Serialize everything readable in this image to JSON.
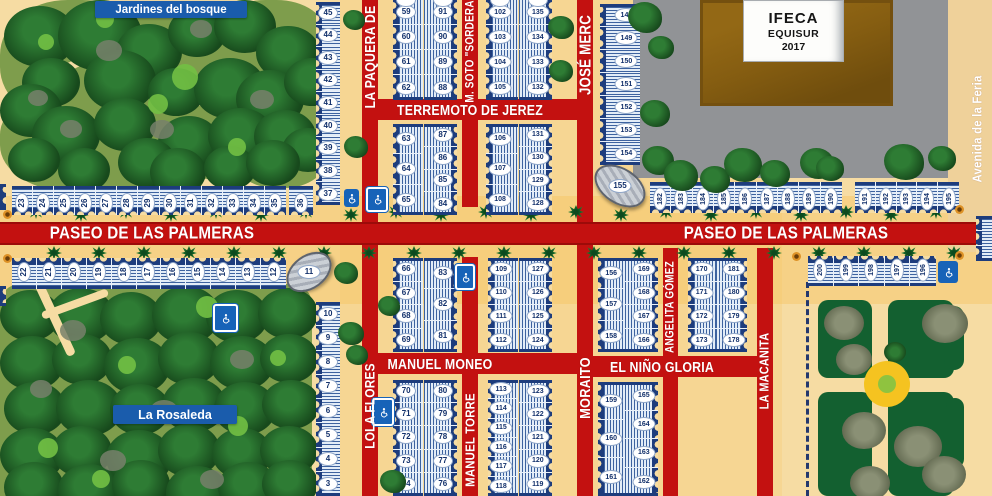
{
  "labels": {
    "jardines": "Jardines del bosque",
    "rosaleda": "La Rosaleda",
    "paseo": "PASEO DE LAS PALMERAS",
    "avenida": "Avenida de la Feria",
    "ifeca_line1": "IFECA",
    "ifeca_line2": "EQUISUR",
    "ifeca_line3": "2017"
  },
  "colors": {
    "ground": "#F6DCA3",
    "navy": "#1D3C7C",
    "road": "#C31110",
    "road_edge": "#9C0B09",
    "caseta_light": "#BFD2E8",
    "stripe_blue": "#264E92",
    "ellipse_text": "#12306B",
    "label_blue": "#1A5CAC",
    "park_olive": "#7E9D4C",
    "tree_dark": "#17491C",
    "tree_mid": "#2E7C34",
    "tree_light": "#72C044",
    "paving_gray": "#919396",
    "building_brown": "#855D11",
    "building_brown_dark": "#6F4D0D",
    "park_deep_green": "#136030",
    "blob_gray": "#7B8465",
    "roundabout_yellow": "#F5C320",
    "roundabout_green": "#8FC33F",
    "icon_blue": "#1763B8",
    "lamp_orange": "#DD9126",
    "dash_navy": "#24386E",
    "avenida_strip": "#EFD19A"
  },
  "streets": [
    {
      "id": "paseo",
      "label": "",
      "x": 0,
      "y": 222,
      "w": 992,
      "h": 23,
      "v": false,
      "fs": 0,
      "lx": 0,
      "ly": 0
    },
    {
      "id": "terremoto-de-jerez",
      "label": "TERREMOTO DE JEREZ",
      "x": 378,
      "y": 99,
      "w": 199,
      "h": 21,
      "v": false,
      "fs": 13,
      "lx": 470,
      "ly": 110
    },
    {
      "id": "manuel-moneo",
      "label": "MANUEL MONEO",
      "x": 378,
      "y": 353,
      "w": 199,
      "h": 21,
      "v": false,
      "fs": 13,
      "lx": 440,
      "ly": 364
    },
    {
      "id": "el-nino-gloria",
      "label": "EL NIÑO GLORIA",
      "x": 593,
      "y": 356,
      "w": 164,
      "h": 21,
      "v": false,
      "fs": 13,
      "lx": 662,
      "ly": 367
    },
    {
      "id": "la-paquera-de",
      "label": "LA PAQUERA DE",
      "x": 362,
      "y": 0,
      "w": 16,
      "h": 222,
      "v": true,
      "fs": 13,
      "lx": 370,
      "ly": 57
    },
    {
      "id": "m-soto-sordera",
      "label": "M. SOTO \"SORDERA\"",
      "x": 462,
      "y": 0,
      "w": 16,
      "h": 207,
      "v": true,
      "fs": 10.5,
      "lx": 470,
      "ly": 49
    },
    {
      "id": "jose-merce",
      "label": "JOSÉ MERC",
      "x": 577,
      "y": 0,
      "w": 16,
      "h": 222,
      "v": true,
      "fs": 14,
      "lx": 585,
      "ly": 55
    },
    {
      "id": "lola-flores",
      "label": "LOLA FLORES",
      "x": 362,
      "y": 245,
      "w": 16,
      "h": 251,
      "v": true,
      "fs": 12.5,
      "lx": 370,
      "ly": 406
    },
    {
      "id": "manuel-torre",
      "label": "MANUEL TORRE",
      "x": 462,
      "y": 257,
      "w": 16,
      "h": 239,
      "v": true,
      "fs": 12,
      "lx": 470,
      "ly": 440
    },
    {
      "id": "moraito",
      "label": "MORAITO",
      "x": 577,
      "y": 245,
      "w": 16,
      "h": 251,
      "v": true,
      "fs": 13.5,
      "lx": 585,
      "ly": 388
    },
    {
      "id": "angelita-gomez",
      "label": "ANGELITA GÓMEZ",
      "x": 663,
      "y": 248,
      "w": 15,
      "h": 248,
      "v": true,
      "fs": 10.5,
      "lx": 670,
      "ly": 307
    },
    {
      "id": "la-macanita",
      "label": "LA MACANITA",
      "x": 757,
      "y": 248,
      "w": 16,
      "h": 248,
      "v": true,
      "fs": 11.5,
      "lx": 765,
      "ly": 371
    }
  ],
  "caseta_groups": [
    {
      "id": "row-23-35",
      "x": 12,
      "y": 186,
      "w": 274,
      "h": 29,
      "dir": "row",
      "stripe": "h",
      "edge": "bottom",
      "rotated": true,
      "numY": 58,
      "numbers": [
        "23",
        "24",
        "25",
        "26",
        "27",
        "28",
        "29",
        "30",
        "31",
        "32",
        "33",
        "34",
        "35"
      ]
    },
    {
      "id": "caseta-36",
      "x": 289,
      "y": 186,
      "w": 24,
      "h": 29,
      "dir": "row",
      "stripe": "h",
      "edge": "bottom",
      "rotated": true,
      "numY": 58,
      "numbers": [
        "36"
      ]
    },
    {
      "id": "col-45-37",
      "x": 316,
      "y": 2,
      "w": 24,
      "h": 203,
      "dir": "col",
      "stripe": "h",
      "edge": "left",
      "numbers": [
        "45",
        "44",
        "43",
        "42",
        "41",
        "40",
        "39",
        "38",
        "37"
      ]
    },
    {
      "id": "col-59-62",
      "x": 393,
      "y": 0,
      "w": 30,
      "h": 100,
      "dir": "col",
      "stripe": "v",
      "edge": "left",
      "numX": 44,
      "phantom": true,
      "numbers": [
        "59",
        "60",
        "61",
        "62"
      ]
    },
    {
      "id": "col-91-88",
      "x": 424,
      "y": 0,
      "w": 33,
      "h": 100,
      "dir": "col",
      "stripe": "v",
      "edge": "right",
      "numX": 57,
      "phantom": true,
      "numbers": [
        "91",
        "90",
        "89",
        "88"
      ]
    },
    {
      "id": "col-102-105",
      "x": 486,
      "y": 0,
      "w": 32,
      "h": 100,
      "dir": "col",
      "stripe": "v",
      "edge": "left",
      "numX": 44,
      "phantom": true,
      "numbers": [
        "102",
        "103",
        "104",
        "105"
      ]
    },
    {
      "id": "col-135-132",
      "x": 519,
      "y": 0,
      "w": 33,
      "h": 100,
      "dir": "col",
      "stripe": "v",
      "edge": "right",
      "numX": 57,
      "phantom": true,
      "numbers": [
        "135",
        "134",
        "133",
        "132"
      ]
    },
    {
      "id": "col-63-65",
      "x": 393,
      "y": 124,
      "w": 30,
      "h": 91,
      "dir": "col",
      "stripe": "v",
      "edge": "left",
      "numX": 44,
      "numbers": [
        "63",
        "64",
        "65"
      ]
    },
    {
      "id": "col-87-84",
      "x": 424,
      "y": 124,
      "w": 33,
      "h": 91,
      "dir": "col",
      "stripe": "v",
      "edge": "right",
      "numX": 57,
      "numbers": [
        "87",
        "86",
        "85",
        "84"
      ]
    },
    {
      "id": "col-106-108",
      "x": 486,
      "y": 124,
      "w": 32,
      "h": 91,
      "dir": "col",
      "stripe": "v",
      "edge": "left",
      "numX": 44,
      "numbers": [
        "106",
        "107",
        "108"
      ]
    },
    {
      "id": "col-131-128",
      "x": 519,
      "y": 124,
      "w": 33,
      "h": 91,
      "dir": "col",
      "stripe": "v",
      "edge": "right",
      "numX": 57,
      "numbers": [
        "131",
        "130",
        "129",
        "128"
      ]
    },
    {
      "id": "col-148-154",
      "x": 600,
      "y": 4,
      "w": 40,
      "h": 161,
      "dir": "col",
      "stripe": "h",
      "edge": "left",
      "numX": 66,
      "numbers": [
        "148",
        "149",
        "150",
        "151",
        "152",
        "153",
        "154"
      ]
    },
    {
      "id": "row-182-190",
      "x": 650,
      "y": 182,
      "w": 192,
      "h": 31,
      "dir": "row",
      "stripe": "h",
      "edge": "bottom",
      "rotated": true,
      "numY": 55,
      "numbers": [
        "182",
        "183",
        "184",
        "185",
        "186",
        "187",
        "188",
        "189",
        "190"
      ]
    },
    {
      "id": "row-191-195",
      "x": 855,
      "y": 182,
      "w": 104,
      "h": 31,
      "dir": "row",
      "stripe": "h",
      "edge": "bottom",
      "rotated": true,
      "numY": 55,
      "numbers": [
        "191",
        "192",
        "193",
        "194",
        "195"
      ]
    },
    {
      "id": "col-edge-right",
      "x": 976,
      "y": 216,
      "w": 16,
      "h": 45,
      "dir": "col",
      "stripe": "h",
      "edge": "left",
      "numbers": [
        "",
        "",
        ""
      ]
    },
    {
      "id": "edge-left-a",
      "x": -6,
      "y": 184,
      "w": 12,
      "h": 26,
      "dir": "col",
      "stripe": "h",
      "edge": "right",
      "numbers": [
        ""
      ]
    },
    {
      "id": "edge-left-b",
      "x": -6,
      "y": 286,
      "w": 12,
      "h": 20,
      "dir": "col",
      "stripe": "h",
      "edge": "right",
      "numbers": [
        ""
      ]
    },
    {
      "id": "row-22-12",
      "x": 12,
      "y": 258,
      "w": 274,
      "h": 31,
      "dir": "row",
      "stripe": "h",
      "edge": "top",
      "rotated": true,
      "numY": 45,
      "numbers": [
        "22",
        "21",
        "20",
        "19",
        "18",
        "17",
        "16",
        "15",
        "14",
        "13",
        "12"
      ]
    },
    {
      "id": "col-10-3",
      "x": 316,
      "y": 302,
      "w": 24,
      "h": 194,
      "dir": "col",
      "stripe": "h",
      "edge": "left",
      "numbers": [
        "10",
        "9",
        "8",
        "7",
        "6",
        "5",
        "4",
        "3"
      ]
    },
    {
      "id": "col-66-69",
      "x": 393,
      "y": 258,
      "w": 30,
      "h": 94,
      "dir": "col",
      "stripe": "v",
      "edge": "left",
      "numX": 44,
      "numbers": [
        "66",
        "67",
        "68",
        "69"
      ]
    },
    {
      "id": "col-83-81",
      "x": 424,
      "y": 258,
      "w": 33,
      "h": 94,
      "dir": "col",
      "stripe": "v",
      "edge": "right",
      "numX": 57,
      "numbers": [
        "83",
        "82",
        "81"
      ]
    },
    {
      "id": "col-70-74",
      "x": 393,
      "y": 380,
      "w": 30,
      "h": 116,
      "dir": "col",
      "stripe": "v",
      "edge": "left",
      "numX": 44,
      "numbers": [
        "70",
        "71",
        "72",
        "73",
        "74"
      ]
    },
    {
      "id": "col-80-76",
      "x": 424,
      "y": 380,
      "w": 33,
      "h": 116,
      "dir": "col",
      "stripe": "v",
      "edge": "right",
      "numX": 57,
      "numbers": [
        "80",
        "79",
        "78",
        "77",
        "76"
      ]
    },
    {
      "id": "col-109-112",
      "x": 488,
      "y": 258,
      "w": 30,
      "h": 94,
      "dir": "col",
      "stripe": "v",
      "edge": "left",
      "numX": 44,
      "numbers": [
        "109",
        "110",
        "111",
        "112"
      ]
    },
    {
      "id": "col-127-124",
      "x": 519,
      "y": 258,
      "w": 33,
      "h": 94,
      "dir": "col",
      "stripe": "v",
      "edge": "right",
      "numX": 57,
      "numbers": [
        "127",
        "126",
        "125",
        "124"
      ]
    },
    {
      "id": "col-113-118",
      "x": 488,
      "y": 380,
      "w": 30,
      "h": 116,
      "dir": "col",
      "stripe": "v",
      "edge": "left",
      "numX": 44,
      "numbers": [
        "113",
        "114",
        "115",
        "116",
        "117",
        "118"
      ]
    },
    {
      "id": "col-123-119",
      "x": 519,
      "y": 380,
      "w": 33,
      "h": 116,
      "dir": "col",
      "stripe": "v",
      "edge": "right",
      "numX": 57,
      "numbers": [
        "123",
        "122",
        "121",
        "120",
        "119"
      ]
    },
    {
      "id": "col-156-158",
      "x": 598,
      "y": 258,
      "w": 30,
      "h": 94,
      "dir": "col",
      "stripe": "v",
      "edge": "left",
      "numX": 44,
      "numbers": [
        "156",
        "157",
        "158"
      ]
    },
    {
      "id": "col-169-166",
      "x": 625,
      "y": 258,
      "w": 33,
      "h": 94,
      "dir": "col",
      "stripe": "v",
      "edge": "right",
      "numX": 57,
      "numbers": [
        "169",
        "168",
        "167",
        "166"
      ]
    },
    {
      "id": "col-159-161",
      "x": 598,
      "y": 382,
      "w": 30,
      "h": 114,
      "dir": "col",
      "stripe": "v",
      "edge": "left",
      "numX": 44,
      "numbers": [
        "159",
        "160",
        "161"
      ]
    },
    {
      "id": "col-165-162",
      "x": 625,
      "y": 382,
      "w": 33,
      "h": 114,
      "dir": "col",
      "stripe": "v",
      "edge": "right",
      "numX": 57,
      "numbers": [
        "165",
        "164",
        "163",
        "162"
      ]
    },
    {
      "id": "col-170-173",
      "x": 688,
      "y": 258,
      "w": 31,
      "h": 94,
      "dir": "col",
      "stripe": "v",
      "edge": "left",
      "numX": 44,
      "numbers": [
        "170",
        "171",
        "172",
        "173"
      ]
    },
    {
      "id": "col-181-178",
      "x": 716,
      "y": 258,
      "w": 31,
      "h": 94,
      "dir": "col",
      "stripe": "v",
      "edge": "right",
      "numX": 57,
      "numbers": [
        "181",
        "180",
        "179",
        "178"
      ]
    },
    {
      "id": "row-200-196",
      "x": 808,
      "y": 256,
      "w": 128,
      "h": 30,
      "dir": "row",
      "stripe": "h",
      "edge": "top",
      "rotated": true,
      "numY": 45,
      "numbers": [
        "200",
        "199",
        "198",
        "197",
        "196"
      ]
    }
  ],
  "stages": [
    {
      "number": "11",
      "x": 284,
      "y": 255,
      "w": 46,
      "h": 30,
      "rot": -36
    },
    {
      "number": "155",
      "x": 592,
      "y": 168,
      "w": 52,
      "h": 32,
      "rot": 33
    }
  ],
  "wheelchair_icons": [
    {
      "x": 344,
      "y": 189,
      "w": 15,
      "h": 18,
      "framed": false
    },
    {
      "x": 366,
      "y": 187,
      "w": 18,
      "h": 21,
      "framed": true
    },
    {
      "x": 213,
      "y": 304,
      "w": 21,
      "h": 24,
      "framed": true
    },
    {
      "x": 455,
      "y": 264,
      "w": 16,
      "h": 22,
      "framed": true
    },
    {
      "x": 372,
      "y": 398,
      "w": 18,
      "h": 24,
      "framed": true
    },
    {
      "x": 938,
      "y": 261,
      "w": 20,
      "h": 22,
      "framed": false
    }
  ],
  "lamps": [
    {
      "x": 3,
      "y": 210
    },
    {
      "x": 3,
      "y": 254
    },
    {
      "x": 792,
      "y": 252
    },
    {
      "x": 955,
      "y": 205
    },
    {
      "x": 955,
      "y": 251
    }
  ],
  "trees": [
    [
      343,
      10,
      22
    ],
    [
      344,
      136,
      24
    ],
    [
      548,
      16,
      26
    ],
    [
      549,
      60,
      24
    ],
    [
      628,
      2,
      34
    ],
    [
      648,
      36,
      26
    ],
    [
      640,
      100,
      30
    ],
    [
      642,
      146,
      32
    ],
    [
      664,
      160,
      34
    ],
    [
      700,
      166,
      30
    ],
    [
      724,
      148,
      38
    ],
    [
      760,
      160,
      30
    ],
    [
      800,
      148,
      34
    ],
    [
      816,
      156,
      28
    ],
    [
      884,
      144,
      40
    ],
    [
      928,
      146,
      28
    ],
    [
      378,
      296,
      22
    ],
    [
      380,
      470,
      26
    ],
    [
      334,
      262,
      24
    ],
    [
      338,
      322,
      26
    ],
    [
      346,
      345,
      22
    ]
  ],
  "palm_rows": {
    "top_y": 206,
    "bottom_y": 246,
    "x_start": 28,
    "x_end": 960,
    "step": 45,
    "bottom_offset": 18
  },
  "boundary_dash": {
    "x": 806,
    "y": 282,
    "h": 214
  },
  "ifeca_grounds": {
    "x": 633,
    "y": 0,
    "w": 315,
    "h": 178
  },
  "ifeca_building": {
    "x": 700,
    "y": 0,
    "w": 193,
    "h": 106
  },
  "ifeca_sign": {
    "x": 743,
    "y": 0,
    "w": 101,
    "h": 62
  },
  "avenida_strip": {
    "x": 948,
    "y": 0,
    "w": 44,
    "h": 252
  }
}
